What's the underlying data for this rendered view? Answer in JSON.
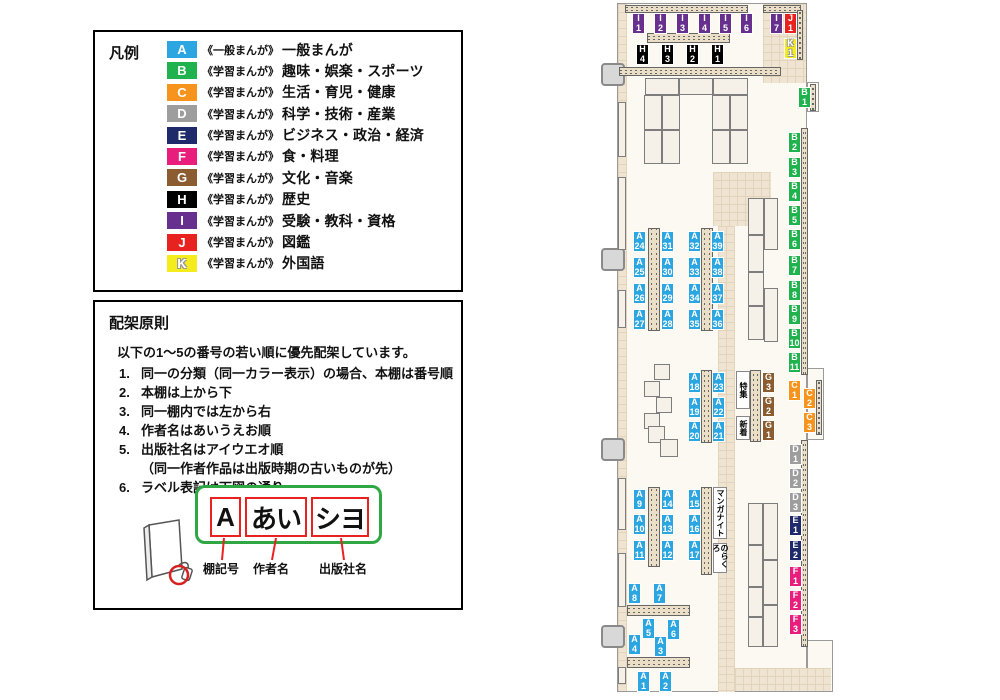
{
  "legend": {
    "title": "凡例",
    "items": [
      {
        "code": "A",
        "color": "#2CA6E0",
        "type": "《一般まんが》",
        "label": "一般まんが",
        "ts": ""
      },
      {
        "code": "B",
        "color": "#1FB24D",
        "type": "《学習まんが》",
        "label": "趣味・娯楽・スポーツ",
        "ts": ""
      },
      {
        "code": "C",
        "color": "#F7941D",
        "type": "《学習まんが》",
        "label": "生活・育児・健康",
        "ts": ""
      },
      {
        "code": "D",
        "color": "#9D9D9E",
        "type": "《学習まんが》",
        "label": "科学・技術・産業",
        "ts": ""
      },
      {
        "code": "E",
        "color": "#1E2A69",
        "type": "《学習まんが》",
        "label": "ビジネス・政治・経済",
        "ts": ""
      },
      {
        "code": "F",
        "color": "#E91D7C",
        "type": "《学習まんが》",
        "label": "食・料理",
        "ts": ""
      },
      {
        "code": "G",
        "color": "#8A5C2F",
        "type": "《学習まんが》",
        "label": "文化・音楽",
        "ts": ""
      },
      {
        "code": "H",
        "color": "#000000",
        "type": "《学習まんが》",
        "label": "歴史",
        "ts": ""
      },
      {
        "code": "I",
        "color": "#67308F",
        "type": "《学習まんが》",
        "label": "受験・教科・資格",
        "ts": ""
      },
      {
        "code": "J",
        "color": "#E8231F",
        "type": "《学習まんが》",
        "label": "図鑑",
        "ts": ""
      },
      {
        "code": "K",
        "color": "#F5EC1E",
        "type": "《学習まんが》",
        "label": "外国語",
        "ts": "-1px -1px 0 #999,1px -1px 0 #999,-1px 1px 0 #999,1px 1px 0 #999"
      }
    ]
  },
  "principles": {
    "title": "配架原則",
    "intro": "以下の1～5の番号の若い順に優先配架しています。",
    "items": [
      {
        "num": "1.",
        "text": "同一の分類（同一カラー表示）の場合、本棚は番号順",
        "note": ""
      },
      {
        "num": "2.",
        "text": "本棚は上から下",
        "note": ""
      },
      {
        "num": "3.",
        "text": "同一棚内では左から右",
        "note": ""
      },
      {
        "num": "4.",
        "text": "作者名はあいうえお順",
        "note": ""
      },
      {
        "num": "5.",
        "text": "出版社名はアイウエオ順",
        "note": "（同一作者作品は出版時期の古いものが先）"
      },
      {
        "num": "6.",
        "text": "ラベル表記は下図の通り",
        "note": ""
      }
    ],
    "label_example": {
      "shelf": "A",
      "author": "あい",
      "publisher": "シヨ"
    },
    "captions": {
      "shelf": "棚記号",
      "author": "作者名",
      "publisher": "出版社名"
    }
  },
  "map": {
    "labels": [
      {
        "c": "I",
        "n": "1",
        "x": 632,
        "y": 13,
        "col": "#67308F",
        "ts": ""
      },
      {
        "c": "I",
        "n": "2",
        "x": 654,
        "y": 13,
        "col": "#67308F",
        "ts": ""
      },
      {
        "c": "I",
        "n": "3",
        "x": 676,
        "y": 13,
        "col": "#67308F",
        "ts": ""
      },
      {
        "c": "I",
        "n": "4",
        "x": 698,
        "y": 13,
        "col": "#67308F",
        "ts": ""
      },
      {
        "c": "I",
        "n": "5",
        "x": 719,
        "y": 13,
        "col": "#67308F",
        "ts": ""
      },
      {
        "c": "I",
        "n": "6",
        "x": 740,
        "y": 13,
        "col": "#67308F",
        "ts": ""
      },
      {
        "c": "I",
        "n": "7",
        "x": 770,
        "y": 13,
        "col": "#67308F",
        "ts": ""
      },
      {
        "c": "J",
        "n": "1",
        "x": 784,
        "y": 13,
        "col": "#E8231F",
        "ts": ""
      },
      {
        "c": "K",
        "n": "1",
        "x": 784,
        "y": 38,
        "col": "#F5EC1E",
        "ts": "-1px -1px 0 #999,1px -1px 0 #999,-1px 1px 0 #999,1px 1px 0 #999"
      },
      {
        "c": "H",
        "n": "4",
        "x": 636,
        "y": 44,
        "col": "#000000",
        "ts": ""
      },
      {
        "c": "H",
        "n": "3",
        "x": 661,
        "y": 44,
        "col": "#000000",
        "ts": ""
      },
      {
        "c": "H",
        "n": "2",
        "x": 686,
        "y": 44,
        "col": "#000000",
        "ts": ""
      },
      {
        "c": "H",
        "n": "1",
        "x": 711,
        "y": 44,
        "col": "#000000",
        "ts": ""
      },
      {
        "c": "B",
        "n": "1",
        "x": 798,
        "y": 87,
        "col": "#1FB24D",
        "ts": ""
      },
      {
        "c": "B",
        "n": "2",
        "x": 788,
        "y": 132,
        "col": "#1FB24D",
        "ts": ""
      },
      {
        "c": "B",
        "n": "3",
        "x": 788,
        "y": 157,
        "col": "#1FB24D",
        "ts": ""
      },
      {
        "c": "B",
        "n": "4",
        "x": 788,
        "y": 181,
        "col": "#1FB24D",
        "ts": ""
      },
      {
        "c": "B",
        "n": "5",
        "x": 788,
        "y": 205,
        "col": "#1FB24D",
        "ts": ""
      },
      {
        "c": "B",
        "n": "6",
        "x": 788,
        "y": 229,
        "col": "#1FB24D",
        "ts": ""
      },
      {
        "c": "B",
        "n": "7",
        "x": 788,
        "y": 255,
        "col": "#1FB24D",
        "ts": ""
      },
      {
        "c": "B",
        "n": "8",
        "x": 788,
        "y": 280,
        "col": "#1FB24D",
        "ts": ""
      },
      {
        "c": "B",
        "n": "9",
        "x": 788,
        "y": 304,
        "col": "#1FB24D",
        "ts": ""
      },
      {
        "c": "B",
        "n": "10",
        "x": 788,
        "y": 328,
        "col": "#1FB24D",
        "ts": ""
      },
      {
        "c": "B",
        "n": "11",
        "x": 788,
        "y": 352,
        "col": "#1FB24D",
        "ts": ""
      },
      {
        "c": "C",
        "n": "1",
        "x": 788,
        "y": 380,
        "col": "#F7941D",
        "ts": ""
      },
      {
        "c": "C",
        "n": "2",
        "x": 803,
        "y": 388,
        "col": "#F7941D",
        "ts": ""
      },
      {
        "c": "C",
        "n": "3",
        "x": 803,
        "y": 412,
        "col": "#F7941D",
        "ts": ""
      },
      {
        "c": "D",
        "n": "1",
        "x": 789,
        "y": 444,
        "col": "#9D9D9E",
        "ts": ""
      },
      {
        "c": "D",
        "n": "2",
        "x": 789,
        "y": 468,
        "col": "#9D9D9E",
        "ts": ""
      },
      {
        "c": "D",
        "n": "3",
        "x": 789,
        "y": 492,
        "col": "#9D9D9E",
        "ts": ""
      },
      {
        "c": "E",
        "n": "1",
        "x": 789,
        "y": 515,
        "col": "#1E2A69",
        "ts": ""
      },
      {
        "c": "E",
        "n": "2",
        "x": 789,
        "y": 540,
        "col": "#1E2A69",
        "ts": ""
      },
      {
        "c": "F",
        "n": "1",
        "x": 789,
        "y": 566,
        "col": "#E91D7C",
        "ts": ""
      },
      {
        "c": "F",
        "n": "2",
        "x": 789,
        "y": 590,
        "col": "#E91D7C",
        "ts": ""
      },
      {
        "c": "F",
        "n": "3",
        "x": 789,
        "y": 614,
        "col": "#E91D7C",
        "ts": ""
      },
      {
        "c": "G",
        "n": "3",
        "x": 762,
        "y": 372,
        "col": "#8A5C2F",
        "ts": ""
      },
      {
        "c": "G",
        "n": "2",
        "x": 762,
        "y": 396,
        "col": "#8A5C2F",
        "ts": ""
      },
      {
        "c": "G",
        "n": "1",
        "x": 762,
        "y": 420,
        "col": "#8A5C2F",
        "ts": ""
      },
      {
        "c": "A",
        "n": "24",
        "x": 633,
        "y": 231,
        "col": "#2CA6E0",
        "ts": ""
      },
      {
        "c": "A",
        "n": "25",
        "x": 633,
        "y": 257,
        "col": "#2CA6E0",
        "ts": ""
      },
      {
        "c": "A",
        "n": "26",
        "x": 633,
        "y": 283,
        "col": "#2CA6E0",
        "ts": ""
      },
      {
        "c": "A",
        "n": "27",
        "x": 633,
        "y": 309,
        "col": "#2CA6E0",
        "ts": ""
      },
      {
        "c": "A",
        "n": "31",
        "x": 661,
        "y": 231,
        "col": "#2CA6E0",
        "ts": ""
      },
      {
        "c": "A",
        "n": "30",
        "x": 661,
        "y": 257,
        "col": "#2CA6E0",
        "ts": ""
      },
      {
        "c": "A",
        "n": "29",
        "x": 661,
        "y": 283,
        "col": "#2CA6E0",
        "ts": ""
      },
      {
        "c": "A",
        "n": "28",
        "x": 661,
        "y": 309,
        "col": "#2CA6E0",
        "ts": ""
      },
      {
        "c": "A",
        "n": "32",
        "x": 688,
        "y": 231,
        "col": "#2CA6E0",
        "ts": ""
      },
      {
        "c": "A",
        "n": "33",
        "x": 688,
        "y": 257,
        "col": "#2CA6E0",
        "ts": ""
      },
      {
        "c": "A",
        "n": "34",
        "x": 688,
        "y": 283,
        "col": "#2CA6E0",
        "ts": ""
      },
      {
        "c": "A",
        "n": "35",
        "x": 688,
        "y": 309,
        "col": "#2CA6E0",
        "ts": ""
      },
      {
        "c": "A",
        "n": "39",
        "x": 711,
        "y": 231,
        "col": "#2CA6E0",
        "ts": ""
      },
      {
        "c": "A",
        "n": "38",
        "x": 711,
        "y": 257,
        "col": "#2CA6E0",
        "ts": ""
      },
      {
        "c": "A",
        "n": "37",
        "x": 711,
        "y": 283,
        "col": "#2CA6E0",
        "ts": ""
      },
      {
        "c": "A",
        "n": "36",
        "x": 711,
        "y": 309,
        "col": "#2CA6E0",
        "ts": ""
      },
      {
        "c": "A",
        "n": "18",
        "x": 688,
        "y": 372,
        "col": "#2CA6E0",
        "ts": ""
      },
      {
        "c": "A",
        "n": "19",
        "x": 688,
        "y": 397,
        "col": "#2CA6E0",
        "ts": ""
      },
      {
        "c": "A",
        "n": "20",
        "x": 688,
        "y": 421,
        "col": "#2CA6E0",
        "ts": ""
      },
      {
        "c": "A",
        "n": "23",
        "x": 712,
        "y": 372,
        "col": "#2CA6E0",
        "ts": ""
      },
      {
        "c": "A",
        "n": "22",
        "x": 712,
        "y": 397,
        "col": "#2CA6E0",
        "ts": ""
      },
      {
        "c": "A",
        "n": "21",
        "x": 712,
        "y": 421,
        "col": "#2CA6E0",
        "ts": ""
      },
      {
        "c": "A",
        "n": "9",
        "x": 633,
        "y": 489,
        "col": "#2CA6E0",
        "ts": ""
      },
      {
        "c": "A",
        "n": "10",
        "x": 633,
        "y": 514,
        "col": "#2CA6E0",
        "ts": ""
      },
      {
        "c": "A",
        "n": "11",
        "x": 633,
        "y": 540,
        "col": "#2CA6E0",
        "ts": ""
      },
      {
        "c": "A",
        "n": "14",
        "x": 661,
        "y": 489,
        "col": "#2CA6E0",
        "ts": ""
      },
      {
        "c": "A",
        "n": "13",
        "x": 661,
        "y": 514,
        "col": "#2CA6E0",
        "ts": ""
      },
      {
        "c": "A",
        "n": "12",
        "x": 661,
        "y": 540,
        "col": "#2CA6E0",
        "ts": ""
      },
      {
        "c": "A",
        "n": "15",
        "x": 688,
        "y": 489,
        "col": "#2CA6E0",
        "ts": ""
      },
      {
        "c": "A",
        "n": "16",
        "x": 688,
        "y": 514,
        "col": "#2CA6E0",
        "ts": ""
      },
      {
        "c": "A",
        "n": "17",
        "x": 688,
        "y": 540,
        "col": "#2CA6E0",
        "ts": ""
      },
      {
        "c": "A",
        "n": "8",
        "x": 628,
        "y": 583,
        "col": "#2CA6E0",
        "ts": ""
      },
      {
        "c": "A",
        "n": "7",
        "x": 653,
        "y": 583,
        "col": "#2CA6E0",
        "ts": ""
      },
      {
        "c": "A",
        "n": "5",
        "x": 642,
        "y": 618,
        "col": "#2CA6E0",
        "ts": ""
      },
      {
        "c": "A",
        "n": "6",
        "x": 667,
        "y": 619,
        "col": "#2CA6E0",
        "ts": ""
      },
      {
        "c": "A",
        "n": "4",
        "x": 628,
        "y": 634,
        "col": "#2CA6E0",
        "ts": ""
      },
      {
        "c": "A",
        "n": "3",
        "x": 654,
        "y": 636,
        "col": "#2CA6E0",
        "ts": ""
      },
      {
        "c": "A",
        "n": "1",
        "x": 637,
        "y": 671,
        "col": "#2CA6E0",
        "ts": ""
      },
      {
        "c": "A",
        "n": "2",
        "x": 659,
        "y": 671,
        "col": "#2CA6E0",
        "ts": ""
      }
    ],
    "notes": [
      {
        "text": "特集",
        "x": 736,
        "y": 371,
        "w": 14,
        "h": 38
      },
      {
        "text": "新着",
        "x": 736,
        "y": 416,
        "w": 14,
        "h": 24
      },
      {
        "text": "マンガナイト",
        "x": 713,
        "y": 487,
        "w": 14,
        "h": 52
      },
      {
        "text": "のらくろ",
        "x": 713,
        "y": 543,
        "w": 14,
        "h": 30
      }
    ]
  }
}
